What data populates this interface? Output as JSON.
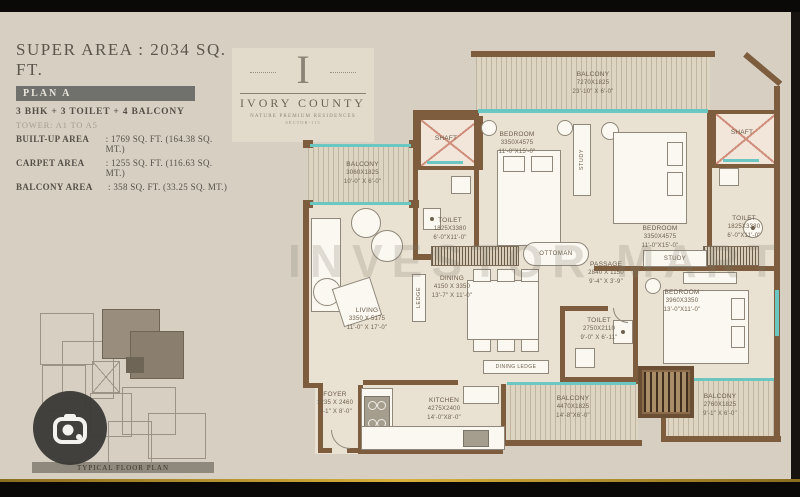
{
  "header": {
    "super_area": "SUPER AREA : 2034 SQ. FT.",
    "plan_label": "PLAN A",
    "configuration": "3 BHK + 3 TOILET + 4 BALCONY",
    "tower": "TOWER: A1 TO A5",
    "areas": [
      {
        "label": "BUILT-UP AREA",
        "value": ": 1769 SQ. FT. (164.38 SQ. MT.)"
      },
      {
        "label": "CARPET AREA",
        "value": ": 1255 SQ. FT. (116.63 SQ. MT.)"
      },
      {
        "label": "BALCONY AREA",
        "value": ": 358 SQ. FT. (33.25 SQ. MT.)"
      }
    ]
  },
  "logo": {
    "monogram": "I",
    "name": "IVORY COUNTY",
    "tagline": "NATURE PREMIUM RESIDENCES",
    "subline": "SECTOR-115"
  },
  "watermark": "INVESTOR MART",
  "plan": {
    "rooms": {
      "balcony_top": {
        "name": "BALCONY",
        "mm": "7270X1825",
        "ft": "23'-10\" X 6'-0\""
      },
      "balcony_left": {
        "name": "BALCONY",
        "mm": "3060X1825",
        "ft": "10'-0\" X 6'-0\""
      },
      "bedroom_1": {
        "name": "BEDROOM",
        "mm": "3350X4575",
        "ft": "11'-0\"X15'-0\""
      },
      "bedroom_2": {
        "name": "BEDROOM",
        "mm": "3350X4575",
        "ft": "11'-0\"X15'-0\""
      },
      "bedroom_3": {
        "name": "BEDROOM",
        "mm": "3960X3350",
        "ft": "13'-0\"X11'-0\""
      },
      "toilet_1": {
        "name": "TOILET",
        "mm": "1825X3380",
        "ft": "6'-0\"X11'-0\""
      },
      "toilet_2": {
        "name": "TOILET",
        "mm": "1825X3380",
        "ft": "6'-0\"X11'-0\""
      },
      "toilet_3": {
        "name": "TOILET",
        "mm": "2750X2110",
        "ft": "9'-0\" X 6'-11\""
      },
      "dining": {
        "name": "DINING",
        "mm": "4150 X 3350",
        "ft": "13'-7\" X 11'-0\""
      },
      "living": {
        "name": "LIVING",
        "mm": "3350 X 5175",
        "ft": "11'-0\" X 17'-0\""
      },
      "passage": {
        "name": "PASSAGE",
        "mm": "2840 X 1150",
        "ft": "9'-4\" X 3'-9\""
      },
      "foyer": {
        "name": "FOYER",
        "mm": "1235 X 2460",
        "ft": "4'-1\" X 8'-0\""
      },
      "kitchen": {
        "name": "KITCHEN",
        "mm": "4275X2400",
        "ft": "14'-0\"X8'-0\""
      },
      "balcony_bottom": {
        "name": "BALCONY",
        "mm": "4470X1825",
        "ft": "14'-8\"X6'-0\""
      },
      "balcony_bottom_right": {
        "name": "BALCONY",
        "mm": "2760X1825",
        "ft": "9'-1\" X 6'-0\""
      }
    },
    "labels": {
      "shaft": "SHAFT",
      "ottoman": "OTTOMAN",
      "study": "STUDY",
      "ledge": "LEDGE",
      "dining_ledge": "DINING LEDGE"
    }
  },
  "keyplan": {
    "caption": "TYPICAL FLOOR PLAN"
  },
  "colors": {
    "gold_line": "#d8b23c",
    "plan_bar_bg": "#70706c",
    "window_teal": "#6cc6c2",
    "wall_brown": "#7d5d3e"
  }
}
